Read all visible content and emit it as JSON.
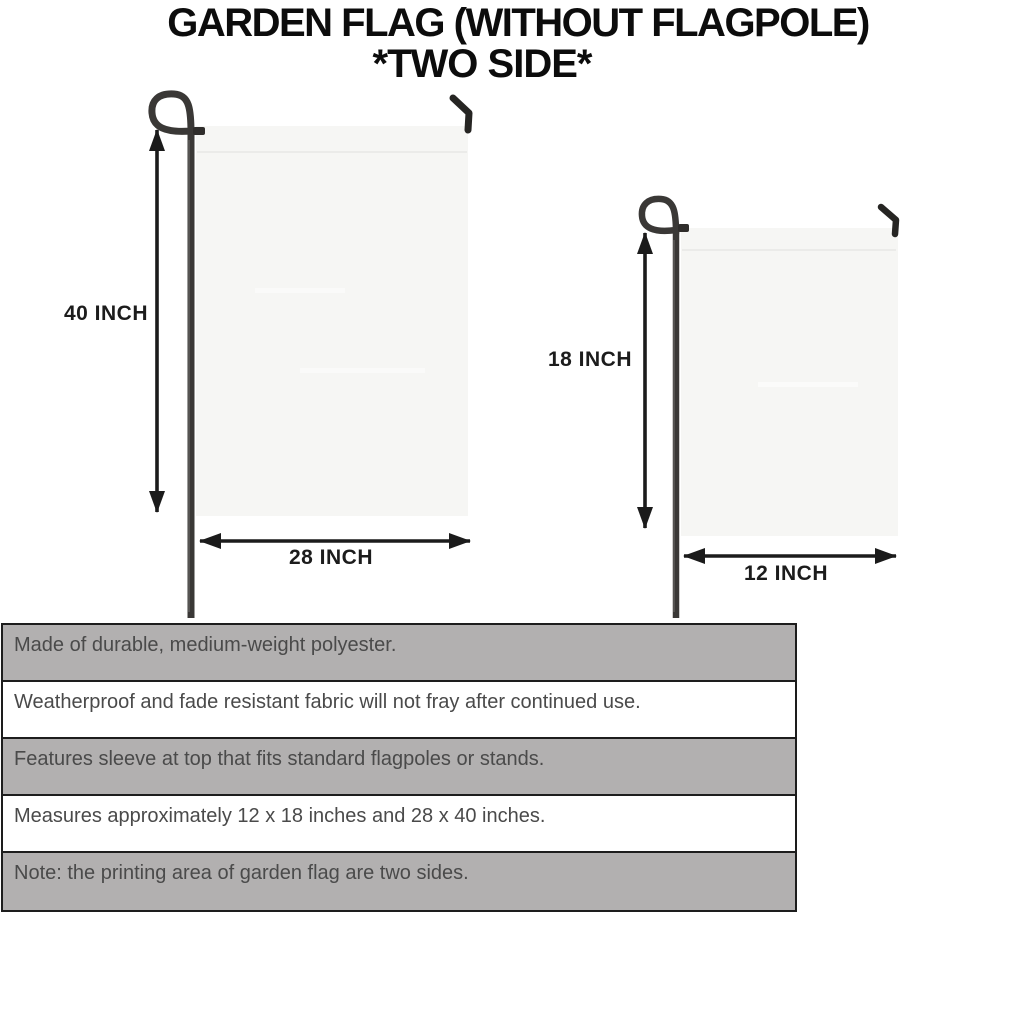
{
  "title": {
    "line1": "GARDEN FLAG (WITHOUT FLAGPOLE)",
    "line2": "*TWO SIDE*"
  },
  "diagrams": [
    {
      "name": "large-flag",
      "height_label": "40 INCH",
      "width_label": "28 INCH"
    },
    {
      "name": "small-flag",
      "height_label": "18 INCH",
      "width_label": "12 INCH"
    }
  ],
  "features": [
    {
      "text": "Made of durable, medium-weight polyester.",
      "shaded": true
    },
    {
      "text": "Weatherproof and fade resistant fabric will not fray after continued use.",
      "shaded": false
    },
    {
      "text": "Features sleeve at top that fits standard flagpoles or stands.",
      "shaded": true
    },
    {
      "text": "Measures approximately 12 x 18 inches and 28 x 40 inches.",
      "shaded": false
    },
    {
      "text": "Note: the printing area of garden flag are two sides.",
      "shaded": true
    }
  ],
  "colors": {
    "row_shaded": "#b2b0b0",
    "row_plain": "#ffffff",
    "table_border": "#1d1d1d",
    "flag_fill": "#f6f6f4",
    "flag_seam": "#ebebe9",
    "pole": "#3a3836",
    "dimension_lines": "#1b1b1b",
    "title_text": "#0c0c0c",
    "table_text": "#4a4a4a",
    "background": "#ffffff"
  }
}
